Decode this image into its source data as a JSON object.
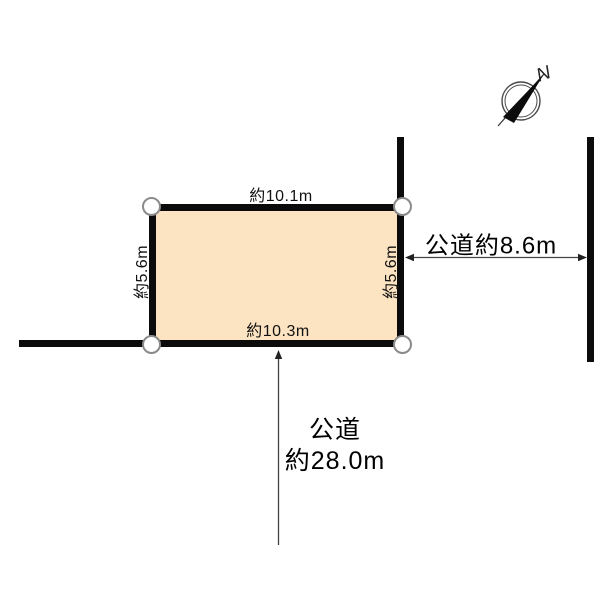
{
  "plot": {
    "top_edge_label": "約10.1m",
    "bottom_edge_label": "約10.3m",
    "left_edge_label": "約5.6m",
    "right_edge_label": "約5.6m"
  },
  "road_right": {
    "label": "公道約8.6m"
  },
  "road_bottom": {
    "label_line1": "公道",
    "label_line2": "約28.0m"
  },
  "compass": {
    "north_label": "N"
  },
  "colors": {
    "plot_fill": "#FCE4C2",
    "line": "#0B0B0B",
    "corner_marker_stroke": "#8A8A8A",
    "arrow": "#444444"
  }
}
